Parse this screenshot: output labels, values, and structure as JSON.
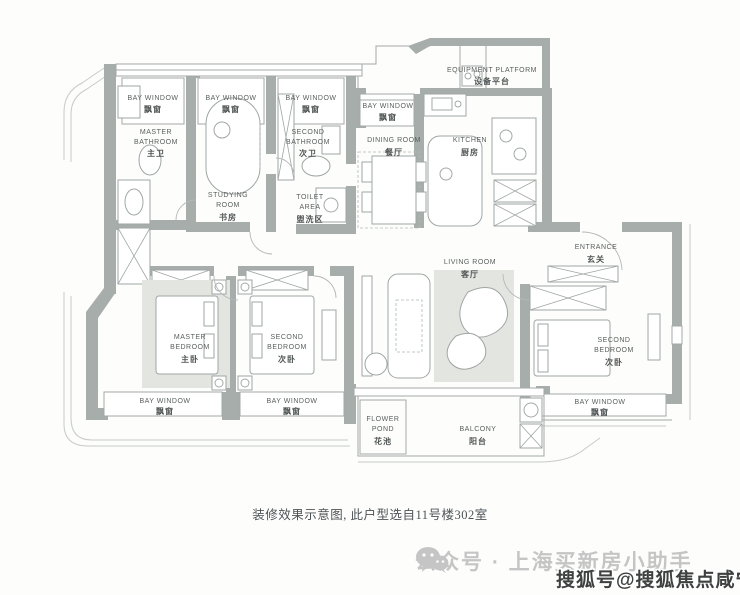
{
  "plan": {
    "rooms": {
      "bay_window": {
        "en": "BAY WINDOW",
        "cn": "飘窗"
      },
      "master_bathroom": {
        "en1": "MASTER",
        "en2": "BATHROOM",
        "cn": "主卫"
      },
      "studying_room": {
        "en1": "STUDYING",
        "en2": "ROOM",
        "cn": "书房"
      },
      "second_bathroom": {
        "en1": "SECOND",
        "en2": "BATHROOM",
        "cn": "次卫"
      },
      "toilet_area": {
        "en1": "TOILET",
        "en2": "AREA",
        "cn": "盥洗区"
      },
      "dining_room": {
        "en": "DINING ROOM",
        "cn": "餐厅"
      },
      "kitchen": {
        "en": "KITCHEN",
        "cn": "厨房"
      },
      "equipment_platform": {
        "en": "EQUIPMENT PLATFORM",
        "cn": "设备平台"
      },
      "entrance": {
        "en": "ENTRANCE",
        "cn": "玄关"
      },
      "living_room": {
        "en": "LIVING ROOM",
        "cn": "客厅"
      },
      "master_bedroom": {
        "en1": "MASTER",
        "en2": "BEDROOM",
        "cn": "主卧"
      },
      "second_bedroom": {
        "en1": "SECOND",
        "en2": "BEDROOM",
        "cn": "次卧"
      },
      "flower_pond": {
        "en1": "FLOWER",
        "en2": "POND",
        "cn": "花池"
      },
      "balcony": {
        "en": "BALCONY",
        "cn": "阳台"
      }
    },
    "caption": "装修效果示意图, 此户型选自11号楼302室",
    "colors": {
      "wall": "#a7adab",
      "label": "#5a605f",
      "rug": "#e3e5e1"
    }
  },
  "watermark": {
    "wechat_text": "公众号 · 上海买新房小助手",
    "sohu_text": "搜狐号@搜狐焦点咸宁站",
    "colors": {
      "wechat": "#c4c5c4",
      "sohu": "#3f4040"
    }
  }
}
